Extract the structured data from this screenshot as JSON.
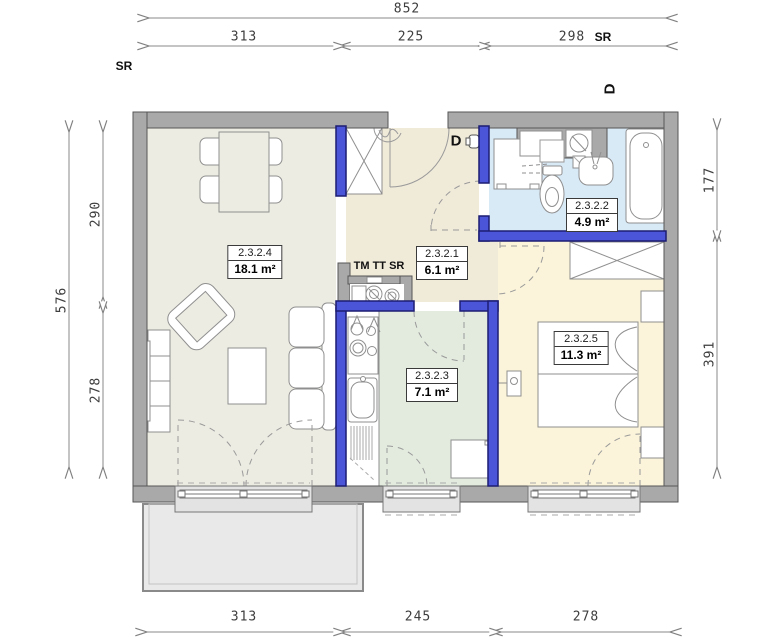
{
  "plan": {
    "type": "apartment-floor-plan",
    "units_note": "cm dimensions as drawn"
  },
  "dims": {
    "top_total": "852",
    "top_segments": [
      "313",
      "225",
      "298"
    ],
    "top_suffix": "SR",
    "left_total": "576",
    "left_segments": [
      "290",
      "278"
    ],
    "right_segments": [
      "177",
      "391"
    ],
    "bottom_segments": [
      "313",
      "245",
      "278"
    ]
  },
  "labels": {
    "sr_left": "SR",
    "door_top": "D",
    "door_entrance": "D",
    "meters": "TM TT SR"
  },
  "rooms": [
    {
      "id": "2.3.2.4",
      "area": "18.1 m²",
      "name": "living-room"
    },
    {
      "id": "2.3.2.1",
      "area": "6.1 m²",
      "name": "hall"
    },
    {
      "id": "2.3.2.2",
      "area": "4.9 m²",
      "name": "bathroom"
    },
    {
      "id": "2.3.2.3",
      "area": "7.1 m²",
      "name": "kitchen"
    },
    {
      "id": "2.3.2.5",
      "area": "11.3 m²",
      "name": "bedroom"
    }
  ],
  "colors": {
    "wall_gray": "#a9a9a9",
    "accent_blue": "#4a55d8",
    "living_floor": "#edece3",
    "hall_floor": "#f0ead9",
    "bathroom_floor": "#d9eaf7",
    "kitchen_floor": "#e3ebdf",
    "bedroom_floor": "#fbf4da",
    "balcony_floor": "#e9e9e9",
    "dimension_line": "#8a8a8a"
  }
}
